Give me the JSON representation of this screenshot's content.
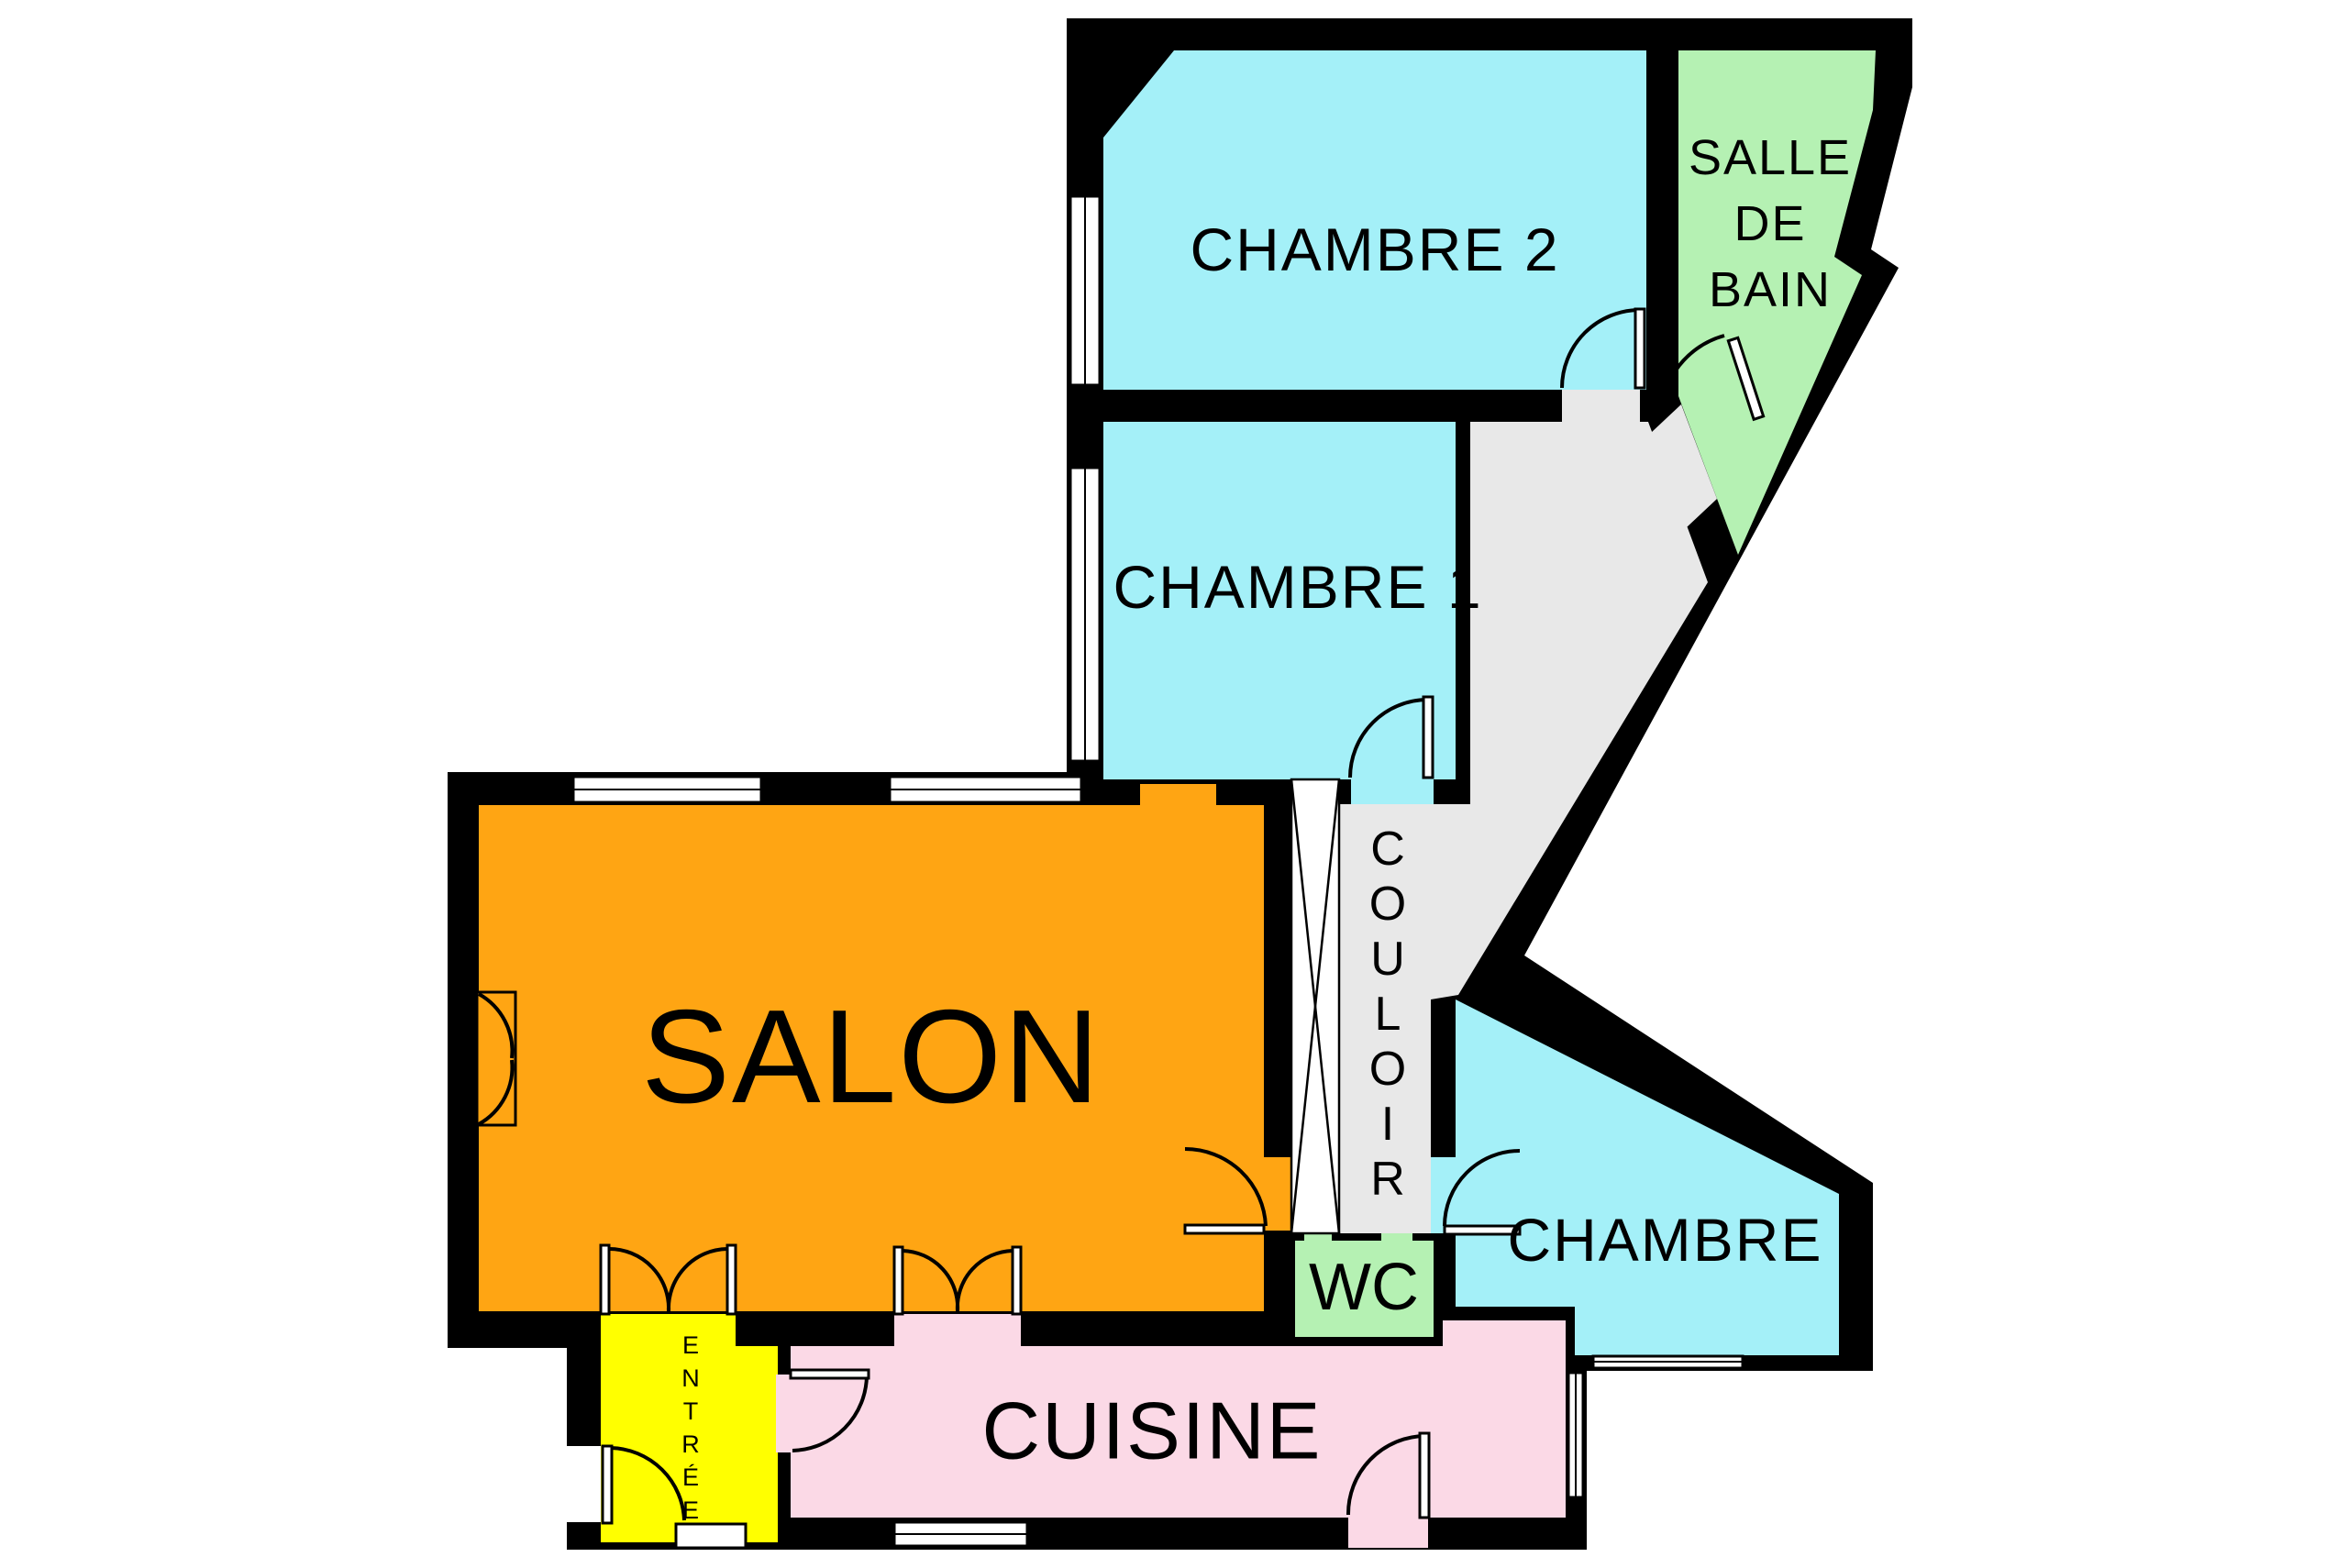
{
  "floorplan": {
    "rooms": {
      "chambre2": {
        "label": "CHAMBRE 2"
      },
      "salle_de_bain": {
        "lines": [
          "SALLE",
          "DE",
          "BAIN"
        ]
      },
      "chambre1": {
        "label": "CHAMBRE 1"
      },
      "salon": {
        "label": "SALON"
      },
      "couloir": {
        "label": "COULOIR",
        "letters": [
          "C",
          "O",
          "U",
          "L",
          "O",
          "I",
          "R"
        ]
      },
      "wc": {
        "label": "WC"
      },
      "chambre3": {
        "label": "CHAMBRE 3"
      },
      "cuisine": {
        "label": "CUISINE"
      },
      "entree": {
        "label": "ENTRÉE",
        "letters": [
          "E",
          "N",
          "T",
          "R",
          "É",
          "E"
        ]
      }
    },
    "colors": {
      "wall": "#000000",
      "exterior": "#FFFFFF",
      "bedroom": "#A4F0F8",
      "bathroom": "#B5F1B3",
      "wc": "#B5F1B3",
      "living": "#FFA513",
      "entry": "#FFFF00",
      "kitchen": "#FBD9E6",
      "corridor": "#E8E8E8",
      "closet": "#FFFFFF",
      "label_text": "#000000"
    }
  }
}
